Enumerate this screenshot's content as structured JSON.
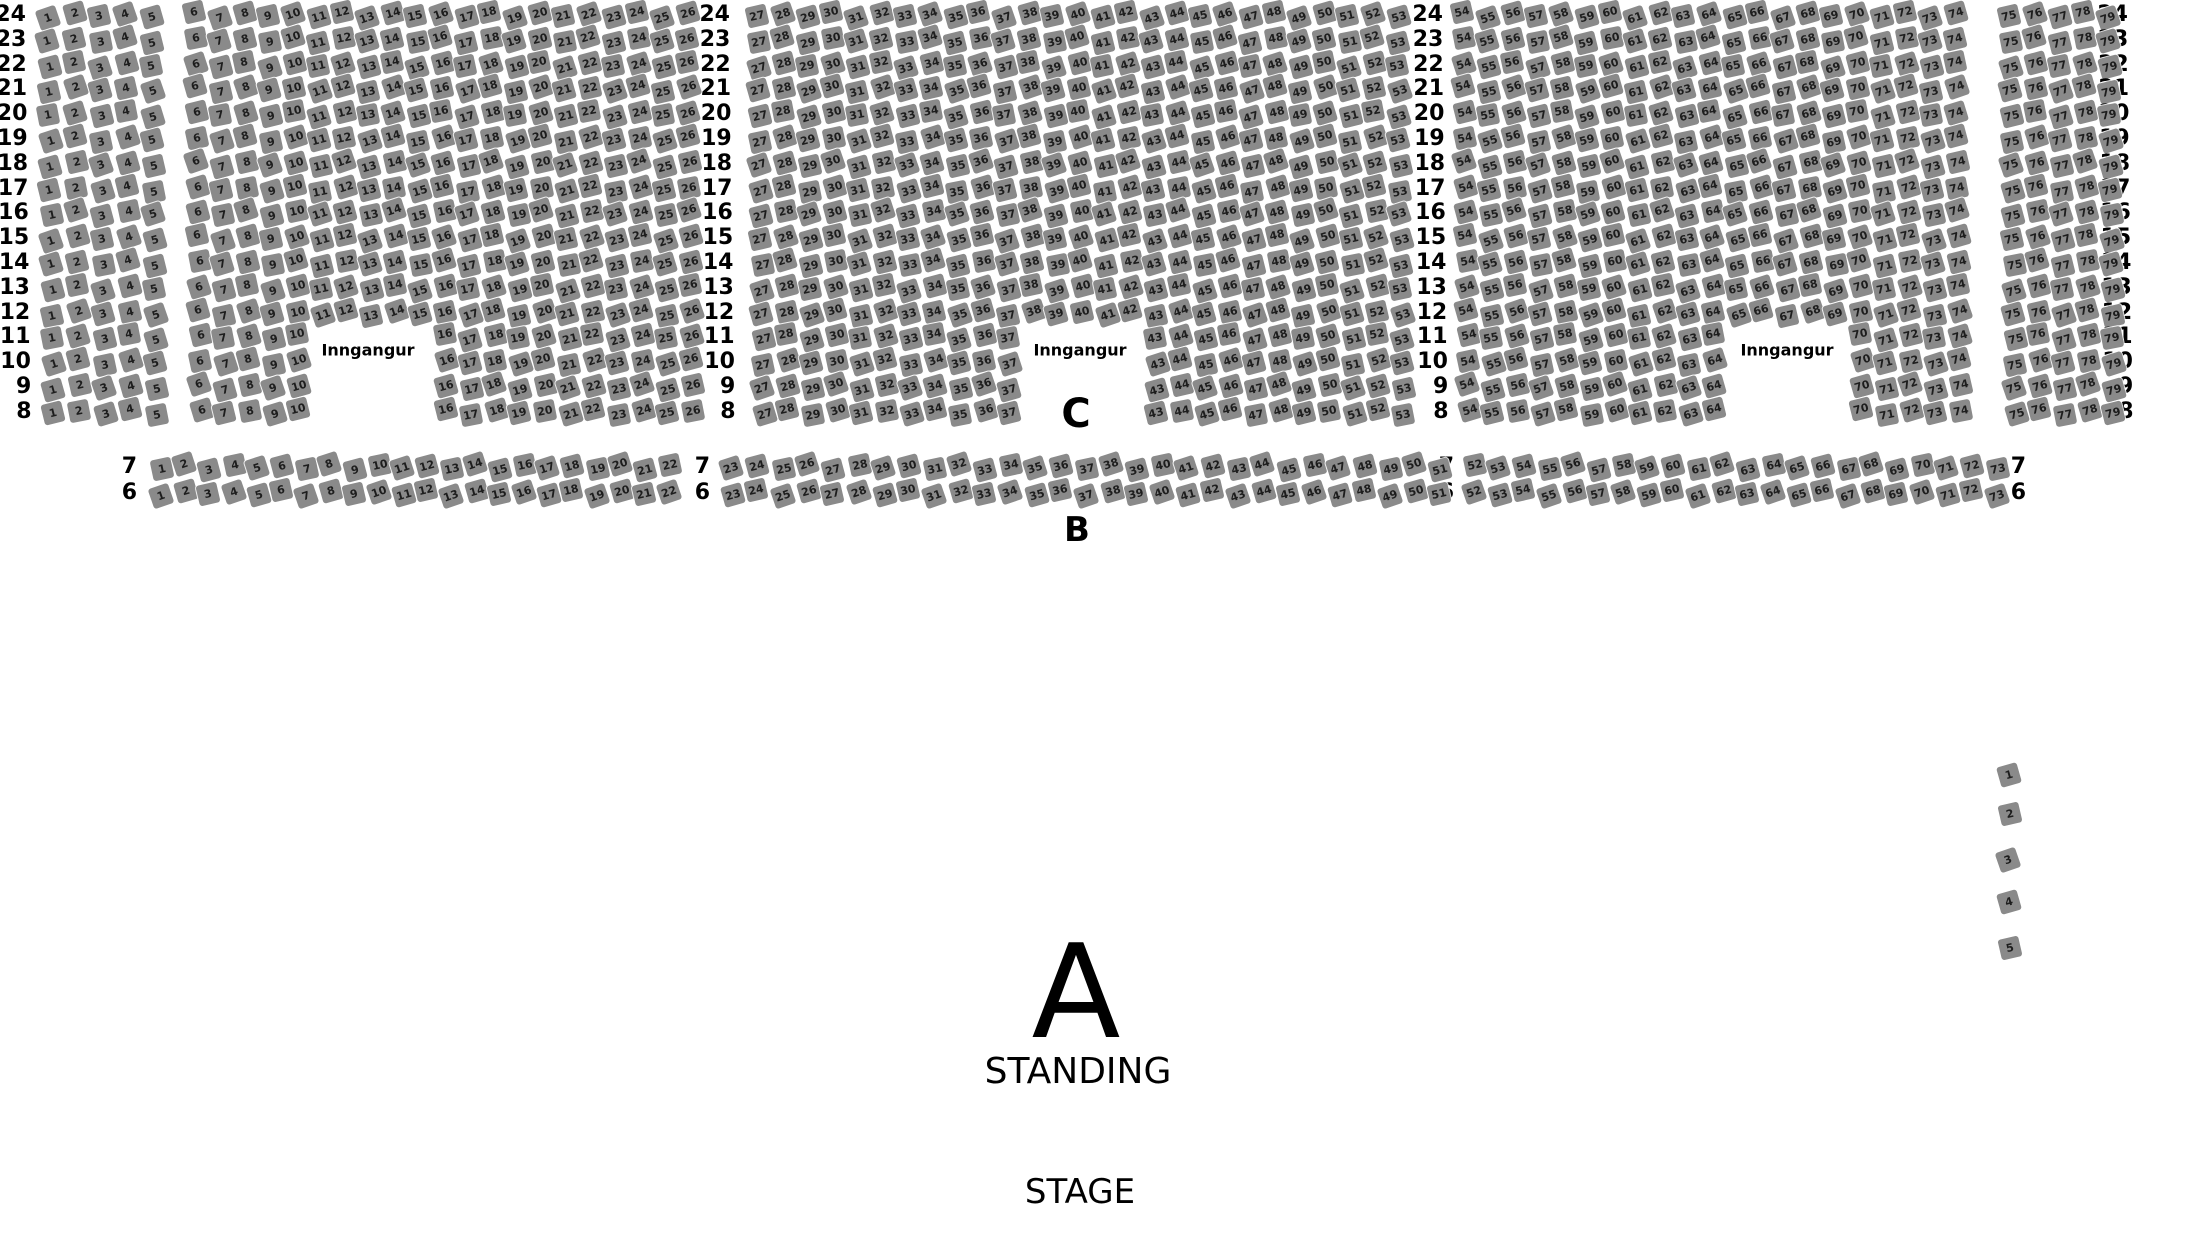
{
  "colors": {
    "background": "#ffffff",
    "seat_fill": "#8a8a8a",
    "seat_text": "#1d1d1d",
    "label_text": "#000000"
  },
  "seat_style": {
    "size": 21,
    "base_rotation_deg": -15
  },
  "section_c": {
    "label": "C",
    "label_pos": {
      "x": 1076,
      "y": 414
    },
    "row_from": 24,
    "row_to": 8,
    "row_top_y": 15,
    "row_spacing": 24.8,
    "row_label_columns_x": [
      26,
      730,
      1443,
      2128
    ],
    "blocks": [
      {
        "seat_from": 1,
        "seat_to": 5,
        "x_start": 48,
        "seat_spacing": 25.8
      },
      {
        "seat_from": 6,
        "seat_to": 26,
        "x_start": 195,
        "seat_spacing": 24.6,
        "cutout": {
          "row_max": 11,
          "row_min": 8,
          "seat_from": 11,
          "seat_to": 15
        }
      },
      {
        "seat_from": 27,
        "seat_to": 53,
        "x_start": 758,
        "seat_spacing": 24.6,
        "cutout": {
          "row_max": 11,
          "row_min": 8,
          "seat_from": 38,
          "seat_to": 42
        }
      },
      {
        "seat_from": 54,
        "seat_to": 74,
        "x_start": 1463,
        "seat_spacing": 24.6,
        "cutout": {
          "row_max": 11,
          "row_min": 8,
          "seat_from": 65,
          "seat_to": 69
        }
      },
      {
        "seat_from": 75,
        "seat_to": 79,
        "x_start": 2010,
        "seat_spacing": 24.6
      }
    ],
    "entrances": [
      {
        "label": "Inngangur",
        "x": 368,
        "y": 350
      },
      {
        "label": "Inngangur",
        "x": 1080,
        "y": 350
      },
      {
        "label": "Inngangur",
        "x": 1787,
        "y": 350
      }
    ]
  },
  "section_b": {
    "label": "B",
    "label_pos": {
      "x": 1077,
      "y": 530
    },
    "rows": [
      {
        "row": 7,
        "y": 467
      },
      {
        "row": 6,
        "y": 493
      }
    ],
    "row_label_columns_x": [
      137,
      710,
      1454,
      2026
    ],
    "blocks": [
      {
        "seat_from": 1,
        "seat_to": 22,
        "x_start": 161,
        "seat_spacing": 24.2
      },
      {
        "seat_from": 23,
        "seat_to": 51,
        "x_start": 732,
        "seat_spacing": 25.3
      },
      {
        "seat_from": 52,
        "seat_to": 73,
        "x_start": 1474,
        "seat_spacing": 24.9
      }
    ]
  },
  "side_seats": {
    "seats": [
      1,
      2,
      3,
      4,
      5
    ],
    "x": 2009,
    "y_start": 772,
    "y_spacing": 43.5
  },
  "section_a": {
    "letter": "A",
    "label": "STANDING",
    "letter_pos": {
      "x": 1076,
      "y": 992
    },
    "label_pos": {
      "x": 1078,
      "y": 1072
    }
  },
  "stage": {
    "label": "STAGE",
    "pos": {
      "x": 1080,
      "y": 1192
    }
  }
}
